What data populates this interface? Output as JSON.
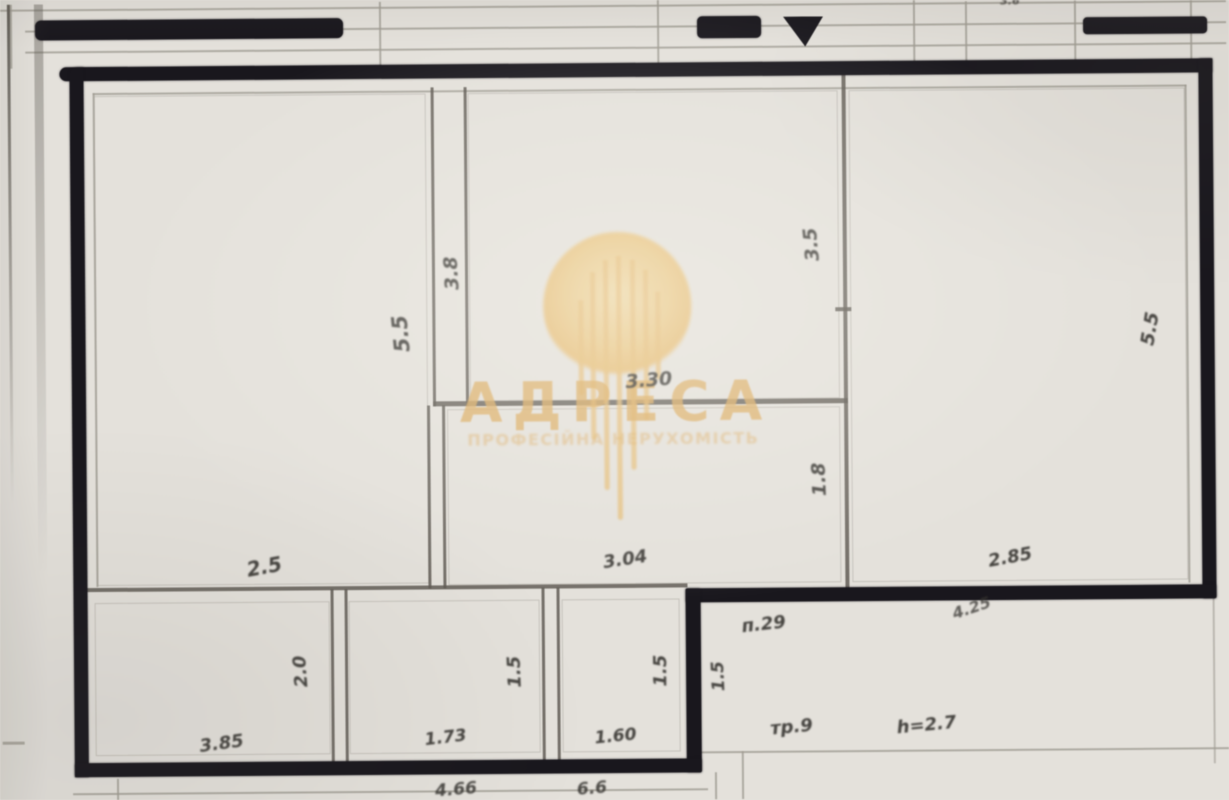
{
  "meta": {
    "kind": "scanned apartment floor plan photo",
    "colors": {
      "paper": "#e7e4de",
      "ink": "#16141a",
      "thin_line": "#5f5b54",
      "faint_line": "#a19d94",
      "label_ink": "#33312d",
      "watermark_gold": "#dfae61"
    }
  },
  "watermark": {
    "brand": "АДРЕСА",
    "tagline": "ПРОФЕСІЙНА НЕРУХОМІСТЬ",
    "logo": "gold-chandelier-circle",
    "streaks": [
      {
        "x": 579,
        "y": 300,
        "h": 95
      },
      {
        "x": 591,
        "y": 272,
        "h": 168
      },
      {
        "x": 604,
        "y": 260,
        "h": 230
      },
      {
        "x": 617,
        "y": 256,
        "h": 264
      },
      {
        "x": 631,
        "y": 260,
        "h": 210
      },
      {
        "x": 644,
        "y": 270,
        "h": 150
      },
      {
        "x": 656,
        "y": 292,
        "h": 88
      }
    ]
  },
  "plan": {
    "thick_walls": [
      {
        "x": 62,
        "y": 63,
        "w": 1153,
        "h": 14,
        "r": "8px 0 0 8px"
      },
      {
        "x": 72,
        "y": 63,
        "w": 14,
        "h": 710,
        "r": "8px 0 0 0"
      },
      {
        "x": 1201,
        "y": 63,
        "w": 14,
        "h": 540
      },
      {
        "x": 684,
        "y": 589,
        "w": 531,
        "h": 14
      },
      {
        "x": 684,
        "y": 589,
        "w": 15,
        "h": 184
      },
      {
        "x": 72,
        "y": 759,
        "w": 627,
        "h": 14
      }
    ],
    "thin_walls": [
      {
        "x": 433,
        "y": 86,
        "w": 2.6,
        "h": 319
      },
      {
        "x": 466,
        "y": 86,
        "w": 2.6,
        "h": 319
      },
      {
        "x": 433,
        "y": 400,
        "w": 415,
        "h": 5
      },
      {
        "x": 844,
        "y": 75,
        "w": 4,
        "h": 518
      },
      {
        "x": 427,
        "y": 404,
        "w": 2.6,
        "h": 183
      },
      {
        "x": 442,
        "y": 404,
        "w": 2.6,
        "h": 183
      },
      {
        "x": 83,
        "y": 584,
        "w": 603,
        "h": 3.5
      },
      {
        "x": 329,
        "y": 587,
        "w": 2.6,
        "h": 175
      },
      {
        "x": 343,
        "y": 587,
        "w": 2.6,
        "h": 175
      },
      {
        "x": 540,
        "y": 587,
        "w": 2.6,
        "h": 175
      },
      {
        "x": 555,
        "y": 587,
        "w": 2.6,
        "h": 175
      },
      {
        "x": 836,
        "y": 309,
        "w": 16,
        "h": 4
      }
    ],
    "faint_lines": [
      {
        "x": 0,
        "y": 5,
        "w": 1229,
        "h": 1.6
      },
      {
        "x": 28,
        "y": 26,
        "w": 1201,
        "h": 1.6
      },
      {
        "x": 28,
        "y": 47,
        "w": 1201,
        "h": 1.6
      },
      {
        "x": 13,
        "y": 0,
        "w": 1.8,
        "h": 64
      },
      {
        "x": 382,
        "y": 0,
        "w": 1.8,
        "h": 64
      },
      {
        "x": 660,
        "y": 0,
        "w": 1.8,
        "h": 64
      },
      {
        "x": 916,
        "y": 0,
        "w": 2.2,
        "h": 64
      },
      {
        "x": 968,
        "y": 4,
        "w": 2.2,
        "h": 60
      },
      {
        "x": 1077,
        "y": 4,
        "w": 2.2,
        "h": 60
      },
      {
        "x": 1193,
        "y": 2,
        "w": 2.2,
        "h": 62
      },
      {
        "x": 10,
        "y": 0,
        "w": 3,
        "h": 500,
        "fade": true
      },
      {
        "x": 37,
        "y": 0,
        "w": 9,
        "h": 570,
        "fade": true,
        "o": 0.45
      },
      {
        "x": 95,
        "y": 89,
        "w": 1094,
        "h": 1.6
      },
      {
        "x": 95,
        "y": 89,
        "w": 1.6,
        "h": 494
      },
      {
        "x": 1187,
        "y": 89,
        "w": 1.6,
        "h": 498
      },
      {
        "x": 70,
        "y": 789,
        "w": 635,
        "h": 1.8
      },
      {
        "x": 697,
        "y": 752,
        "w": 532,
        "h": 1.6
      },
      {
        "x": 1211,
        "y": 603,
        "w": 1.8,
        "h": 165,
        "o": 0.6
      },
      {
        "x": 712,
        "y": 773,
        "w": 1.8,
        "h": 27
      },
      {
        "x": 739,
        "y": 752,
        "w": 1.8,
        "h": 48
      },
      {
        "x": 0,
        "y": 737,
        "w": 22,
        "h": 2.5
      },
      {
        "x": 114,
        "y": 775,
        "w": 2.2,
        "h": 25
      }
    ],
    "room_outlines": [
      {
        "x": 96,
        "y": 92,
        "w": 330,
        "h": 488
      },
      {
        "x": 470,
        "y": 92,
        "w": 368,
        "h": 306
      },
      {
        "x": 851,
        "y": 92,
        "w": 334,
        "h": 490
      },
      {
        "x": 447,
        "y": 408,
        "w": 391,
        "h": 174
      },
      {
        "x": 93,
        "y": 599,
        "w": 233,
        "h": 151
      },
      {
        "x": 347,
        "y": 599,
        "w": 189,
        "h": 151
      },
      {
        "x": 560,
        "y": 599,
        "w": 116,
        "h": 151
      }
    ],
    "black_bars": [
      {
        "x": 38,
        "y": 16,
        "w": 308,
        "h": 20,
        "r": "6px"
      },
      {
        "x": 700,
        "y": 17,
        "w": 64,
        "h": 22,
        "r": "5px"
      },
      {
        "x": 786,
        "y": 18,
        "w": 40,
        "h": 30,
        "clip": "polygon(0 0,100% 0,55% 100%)"
      },
      {
        "x": 1086,
        "y": 21,
        "w": 124,
        "h": 17,
        "r": "4px"
      }
    ],
    "dimension_labels": [
      {
        "text": "5.5",
        "x": 402,
        "y": 332,
        "rot": -95,
        "size": 21
      },
      {
        "text": "3.8",
        "x": 453,
        "y": 272,
        "rot": -93,
        "size": 19
      },
      {
        "text": "3.30",
        "x": 649,
        "y": 381,
        "rot": -4,
        "size": 19
      },
      {
        "text": "3.5",
        "x": 813,
        "y": 246,
        "rot": -95,
        "size": 19
      },
      {
        "text": "1.8",
        "x": 819,
        "y": 481,
        "rot": -92,
        "size": 19
      },
      {
        "text": "5.5",
        "x": 1151,
        "y": 333,
        "rot": -80,
        "size": 19
      },
      {
        "text": "2.5",
        "x": 263,
        "y": 564,
        "rot": -10,
        "size": 20
      },
      {
        "text": "3.04",
        "x": 624,
        "y": 560,
        "rot": -8,
        "size": 18
      },
      {
        "text": "2.85",
        "x": 1009,
        "y": 561,
        "rot": -10,
        "size": 18
      },
      {
        "text": "4.25",
        "x": 970,
        "y": 611,
        "rot": -18,
        "size": 16,
        "opacity": 0.75
      },
      {
        "text": "п.29",
        "x": 762,
        "y": 626,
        "rot": -6,
        "size": 18
      },
      {
        "text": "1.5",
        "x": 717,
        "y": 677,
        "rot": -92,
        "size": 17
      },
      {
        "text": "тр.9",
        "x": 789,
        "y": 729,
        "rot": -5,
        "size": 18
      },
      {
        "text": "h=2.7",
        "x": 924,
        "y": 728,
        "rot": -5,
        "size": 18
      },
      {
        "text": "2.0",
        "x": 299,
        "y": 669,
        "rot": -94,
        "size": 18
      },
      {
        "text": "3.85",
        "x": 219,
        "y": 741,
        "rot": -7,
        "size": 18
      },
      {
        "text": "1.5",
        "x": 513,
        "y": 671,
        "rot": -92,
        "size": 18
      },
      {
        "text": "1.73",
        "x": 443,
        "y": 737,
        "rot": -6,
        "size": 17
      },
      {
        "text": "1.5",
        "x": 659,
        "y": 671,
        "rot": -90,
        "size": 18
      },
      {
        "text": "1.60",
        "x": 613,
        "y": 737,
        "rot": -5,
        "size": 17
      },
      {
        "text": "4.66",
        "x": 453,
        "y": 789,
        "rot": -4,
        "size": 17,
        "opacity": 0.85
      },
      {
        "text": "6.6",
        "x": 589,
        "y": 789,
        "rot": -4,
        "size": 17,
        "opacity": 0.85
      },
      {
        "text": "3.6",
        "x": 1013,
        "y": 4,
        "rot": 0,
        "size": 11,
        "opacity": 0.8
      }
    ]
  }
}
